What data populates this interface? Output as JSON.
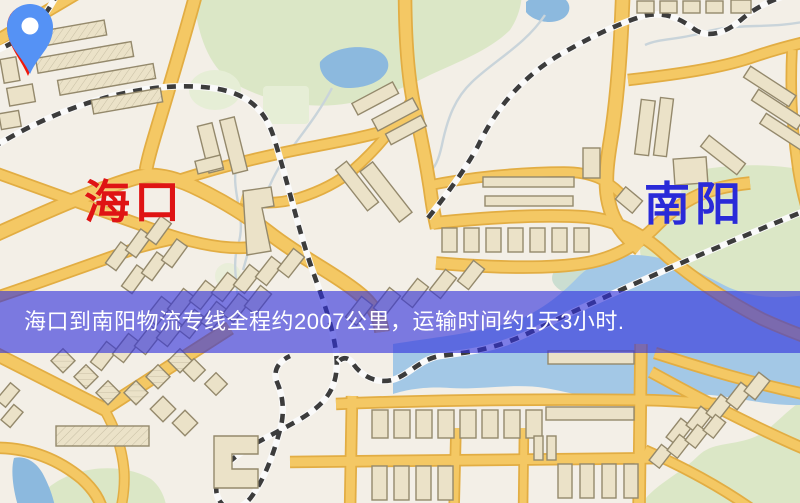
{
  "banner": {
    "text": "海口到南阳物流专线全程约2007公里，运输时间约1天3小时.",
    "background": "rgba(48,48,220,0.62)",
    "text_color": "#ffffff"
  },
  "origin": {
    "label": "海口",
    "pin_color": "#ef1a0c",
    "pin_dot_color": "#ffffff",
    "label_color": "#df1414"
  },
  "destination": {
    "label": "南阳",
    "pin_color": "#5592f5",
    "pin_dot_color": "#ffffff",
    "label_color": "#2a2ad8"
  },
  "route_info": {
    "from": "海口",
    "to": "南阳",
    "distance_text": "约2007公里",
    "duration_text": "约1天3小时"
  },
  "map_theme": {
    "land": "#f3efe7",
    "park": "#dbe7c6",
    "park_light": "#e6eed6",
    "marsh": "#bdd8c9",
    "water": "#8cb9de",
    "water_river": "#a3c8e6",
    "stream": "#c9d4da",
    "road": "#f4c864",
    "road_edge": "#e2ad43",
    "building_fill": "#ebe2c8",
    "building_stroke": "#94896c",
    "rail_dash": "#3c3c3c",
    "rail_base": "#fafafa"
  }
}
